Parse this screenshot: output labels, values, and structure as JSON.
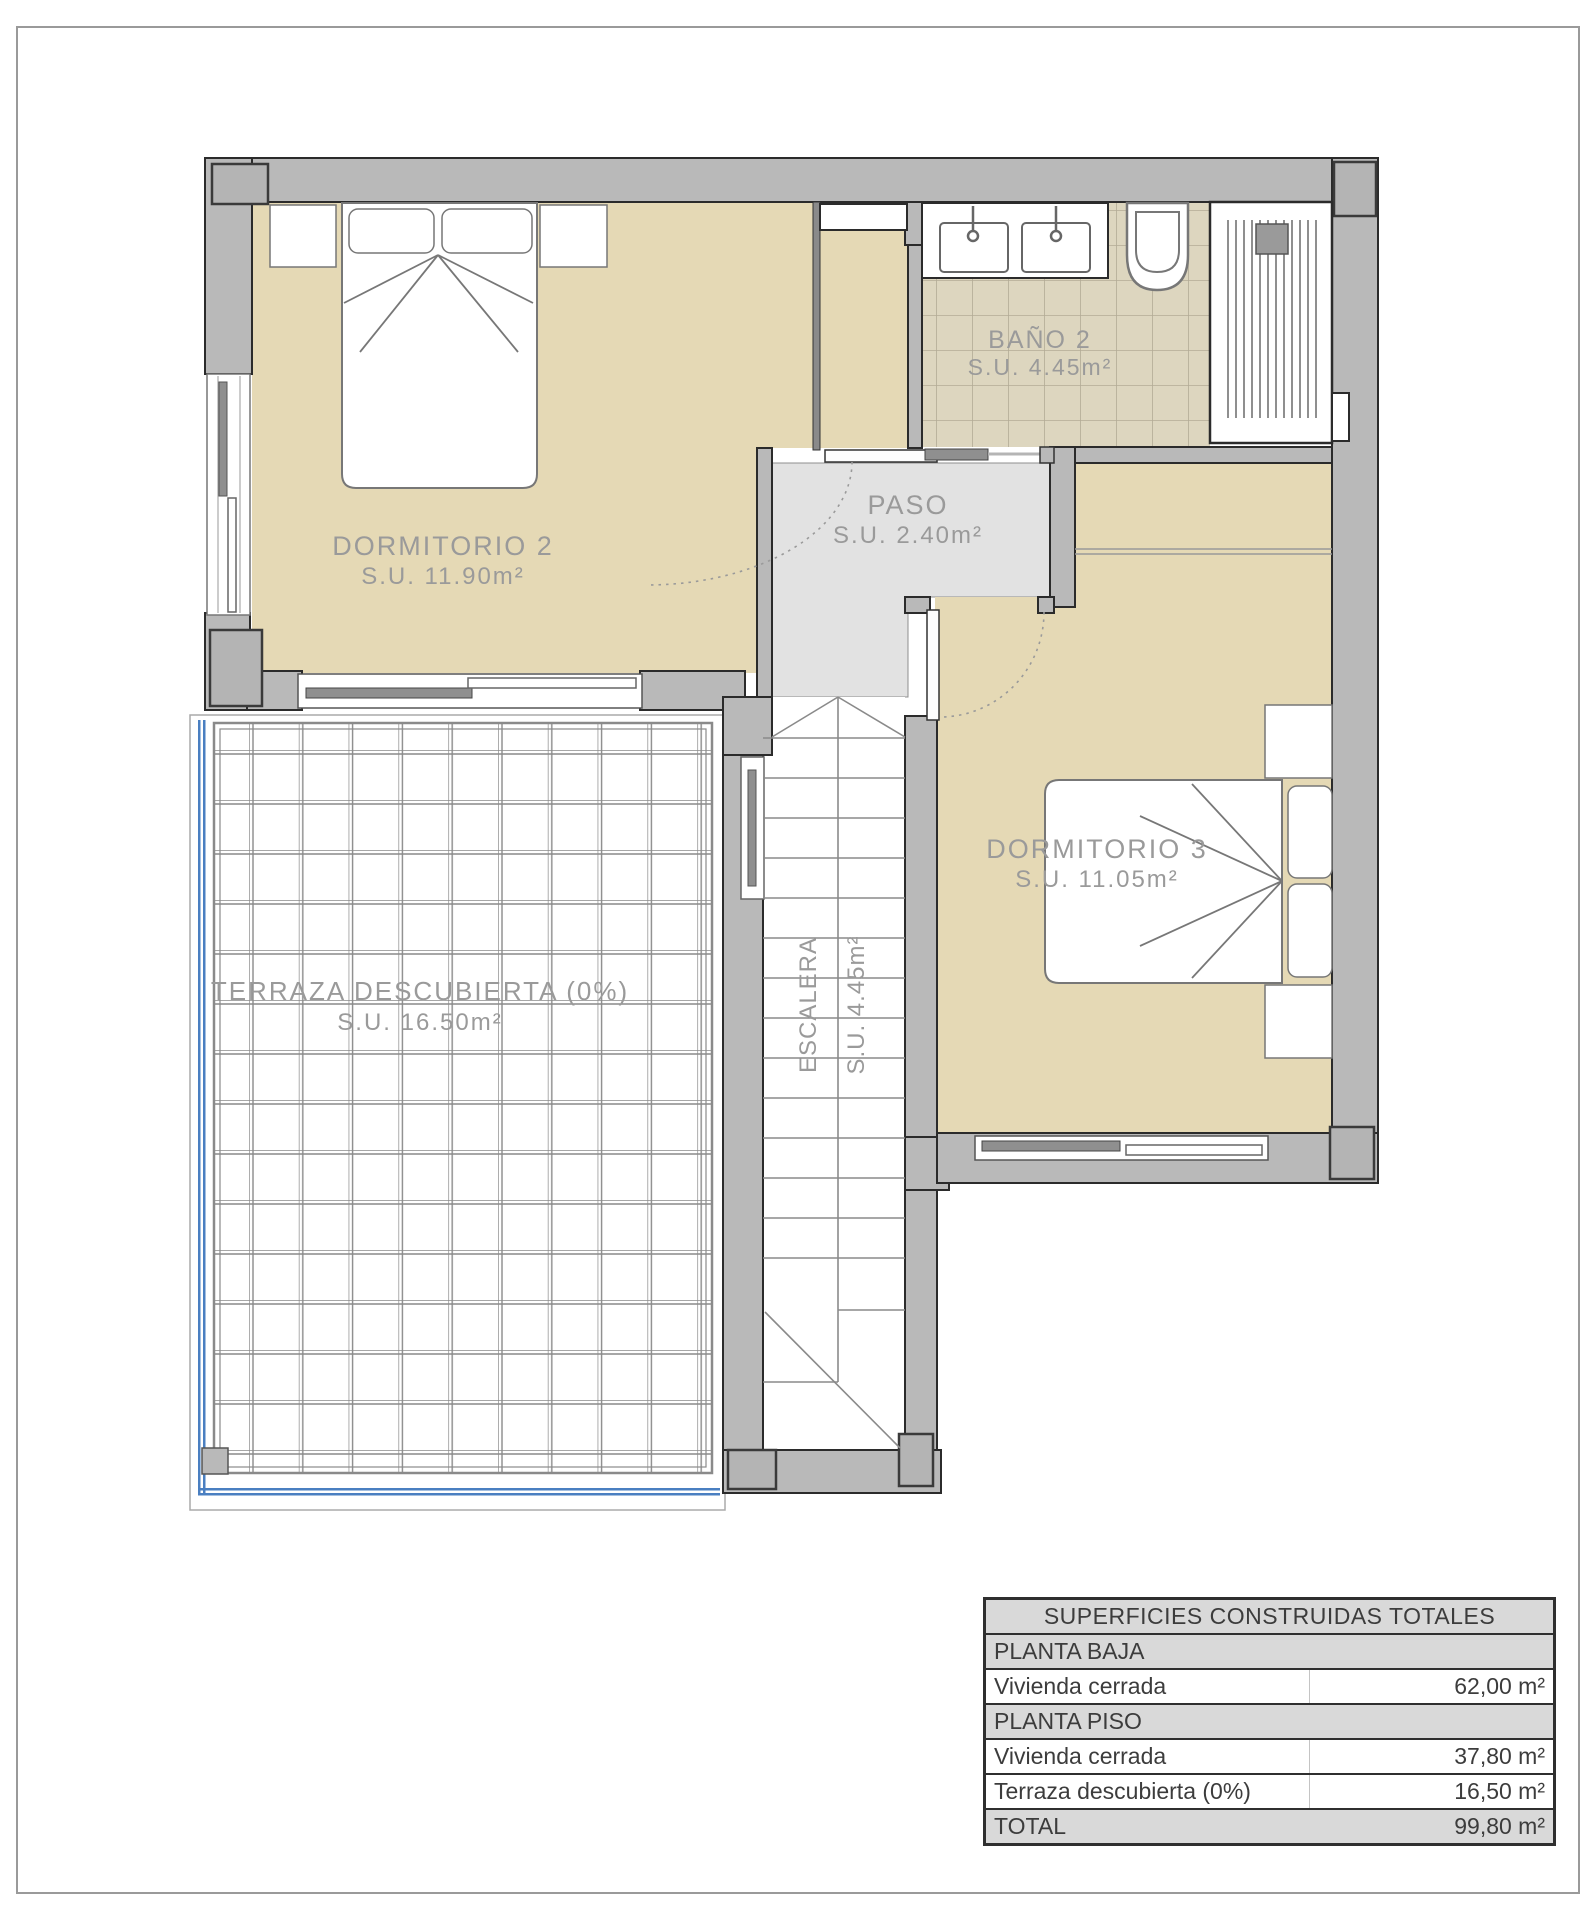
{
  "plan": {
    "rooms": {
      "dormitorio2": {
        "name": "DORMITORIO 2",
        "area": "S.U. 11.90m²"
      },
      "bano2": {
        "name": "BAÑO 2",
        "area": "S.U. 4.45m²"
      },
      "paso": {
        "name": "PASO",
        "area": "S.U. 2.40m²"
      },
      "dormitorio3": {
        "name": "DORMITORIO 3",
        "area": "S.U. 11.05m²"
      },
      "escalera": {
        "name": "ESCALERA",
        "area": "S.U. 4.45m²"
      },
      "terraza": {
        "name": "TERRAZA DESCUBIERTA (0%)",
        "area": "S.U. 16.50m²"
      }
    },
    "colors": {
      "wall": "#b9b9b9",
      "wall_outline": "#2b2b2b",
      "room_floor": "#e5d9b5",
      "bath_tile": "#ddd6bf",
      "paso_floor": "#e2e2e2",
      "label_text": "#9a9a9a",
      "water_line_blue": "#4a7fc1"
    }
  },
  "summary_table": {
    "title": "SUPERFICIES CONSTRUIDAS TOTALES",
    "rows": [
      {
        "label": "PLANTA BAJA",
        "value": ""
      },
      {
        "label": "Vivienda cerrada",
        "value": "62,00 m²"
      },
      {
        "label": "PLANTA PISO",
        "value": ""
      },
      {
        "label": "Vivienda cerrada",
        "value": "37,80 m²"
      },
      {
        "label": "Terraza descubierta (0%)",
        "value": "16,50 m²"
      },
      {
        "label": "TOTAL",
        "value": "99,80 m²"
      }
    ]
  }
}
